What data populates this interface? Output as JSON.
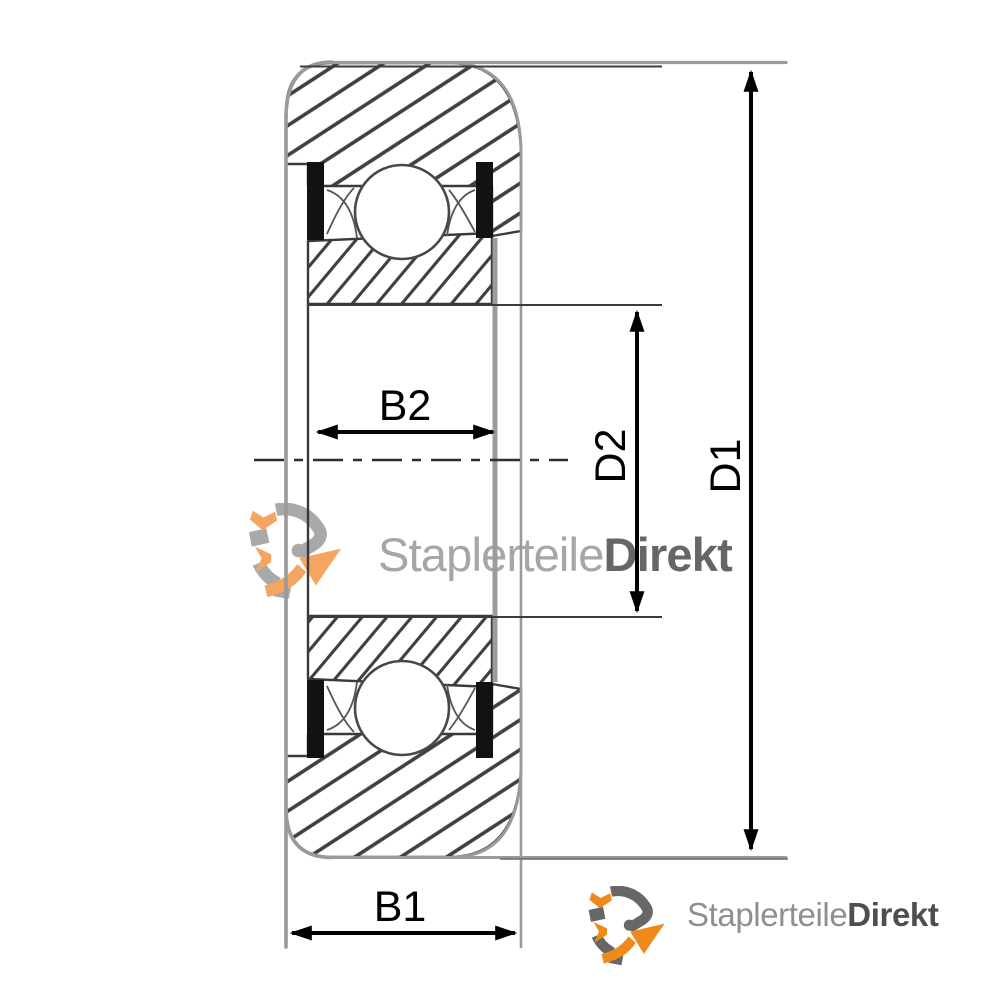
{
  "page": {
    "background": "#ffffff"
  },
  "diagram": {
    "type": "bearing-cross-section-dimension-drawing",
    "labels": {
      "b1": "B1",
      "b2": "B2",
      "d1": "D1",
      "d2": "D2"
    },
    "colors": {
      "dimension_line": "#000000",
      "hatch": "#3f3f3f",
      "wheel_outline": "#9a9a9a",
      "seal": "#121212",
      "centerline": "#2e2e2e"
    }
  },
  "watermark": {
    "icon": "gear-arrows-logo",
    "text_normal": "Staplerteile",
    "text_bold": "Direkt",
    "color_normal": "#a6a6a6",
    "color_bold": "#666666",
    "icon_gray": "#9e9e9e",
    "icon_orange": "#f3994a"
  },
  "footer_logo": {
    "icon": "gear-arrows-logo",
    "text_normal": "Staplerteile",
    "text_bold": "Direkt",
    "color_normal": "#8f8f8f",
    "color_bold": "#4e4e4e",
    "icon_gray": "#676767",
    "icon_orange": "#ee8a1c"
  }
}
